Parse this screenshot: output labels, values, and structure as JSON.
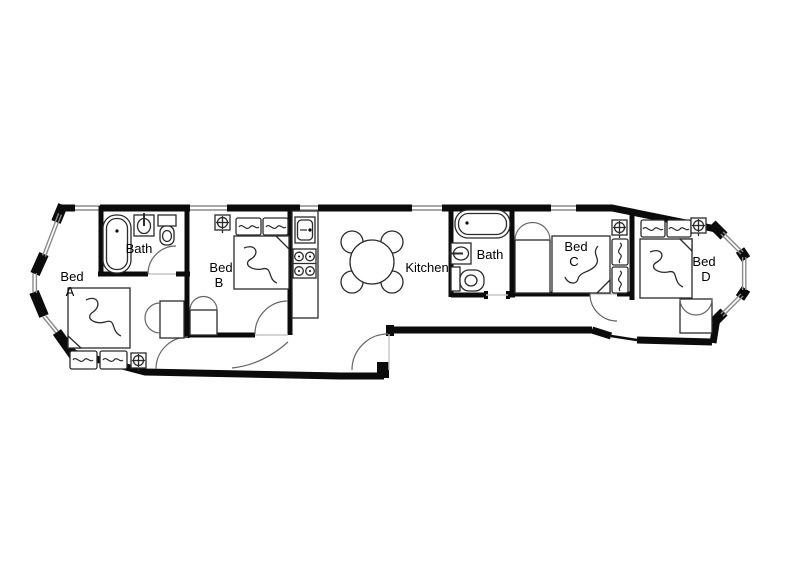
{
  "page": {
    "type": "apartment-floor-plan",
    "background": "#ffffff",
    "colors": {
      "wall": "#0b0b0b",
      "window": "#8a8a8a",
      "furniture_stroke": "#2b2b2b",
      "door_arc": "#666666",
      "text": "#000000"
    }
  },
  "floorplan": {
    "rooms": [
      {
        "id": "bed-a",
        "label": "Bed A",
        "label_lines": [
          "Bed",
          "A"
        ],
        "furniture": [
          "double-bed",
          "pillow",
          "pillow",
          "closet-bifold",
          "ceiling-light"
        ]
      },
      {
        "id": "bath-1",
        "label": "Bath",
        "furniture": [
          "bathtub",
          "washbasin",
          "toilet"
        ]
      },
      {
        "id": "bed-b",
        "label": "Bed B",
        "label_lines": [
          "Bed",
          "B"
        ],
        "furniture": [
          "double-bed",
          "pillow",
          "pillow",
          "closet-bifold",
          "ceiling-light"
        ]
      },
      {
        "id": "kitchen",
        "label": "Kitchen",
        "furniture": [
          "kitchen-counter",
          "kitchen-sink",
          "stove-4-burner",
          "dining-table",
          "chair",
          "chair",
          "chair",
          "chair"
        ]
      },
      {
        "id": "bath-2",
        "label": "Bath",
        "furniture": [
          "bathtub",
          "washbasin",
          "toilet"
        ]
      },
      {
        "id": "bed-c",
        "label": "Bed C",
        "label_lines": [
          "Bed",
          "C"
        ],
        "furniture": [
          "double-bed",
          "pillow",
          "pillow",
          "closet-bifold",
          "ceiling-light"
        ]
      },
      {
        "id": "bed-d",
        "label": "Bed D",
        "label_lines": [
          "Bed",
          "D"
        ],
        "furniture": [
          "double-bed",
          "pillow",
          "pillow",
          "wardrobe",
          "ceiling-light"
        ]
      }
    ],
    "features": [
      "bay-window-left",
      "bay-window-right",
      "entrance-door",
      "corridor",
      "windows-top-wall"
    ]
  }
}
